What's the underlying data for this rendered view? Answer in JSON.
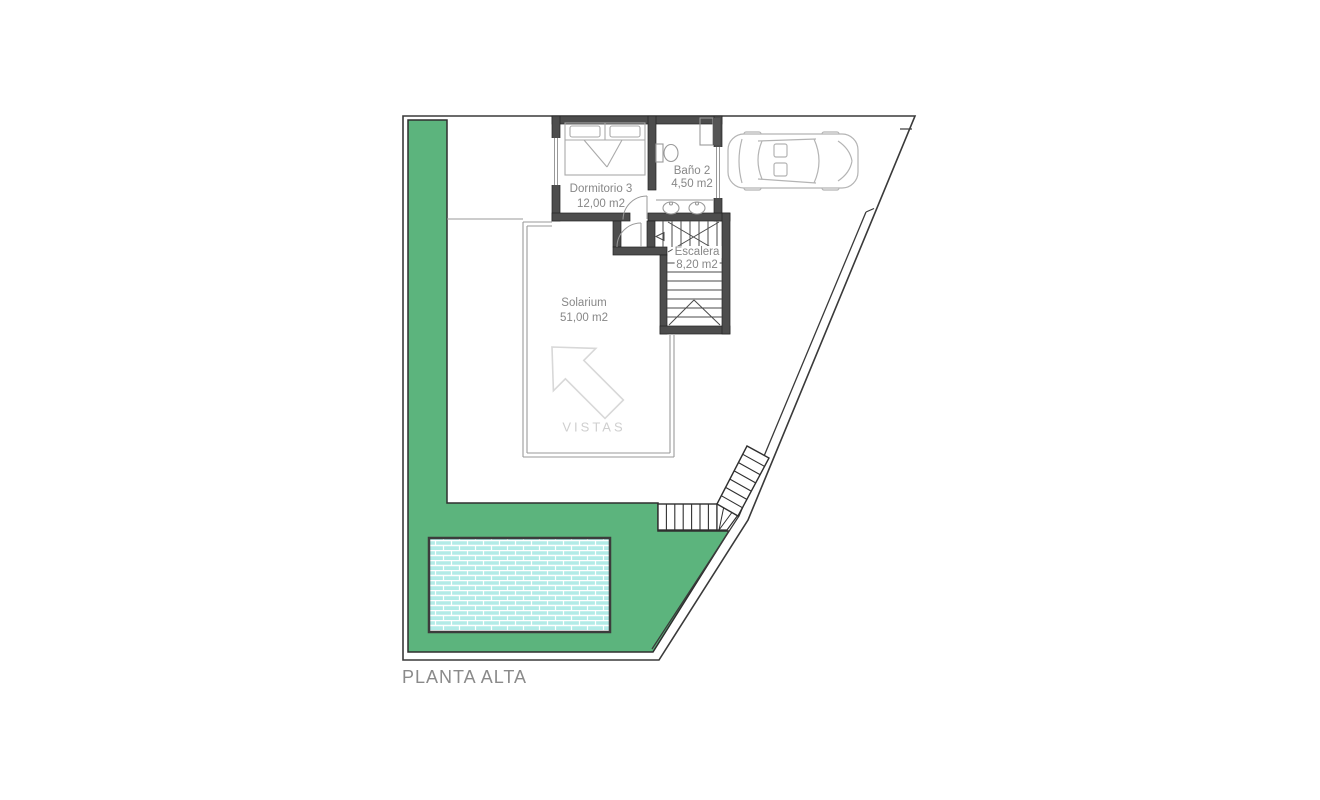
{
  "plan": {
    "title": "PLANTA ALTA",
    "rooms": {
      "dormitorio3": {
        "name": "Dormitorio 3",
        "area": "12,00 m2"
      },
      "bano2": {
        "name": "Baño 2",
        "area": "4,50 m2"
      },
      "escalera": {
        "name": "Escalera",
        "area": "8,20 m2"
      },
      "solarium": {
        "name": "Solarium",
        "area": "51,00 m2"
      }
    },
    "annotations": {
      "vistas": "VISTAS"
    },
    "colors": {
      "garden": "#5cb47d",
      "pool_water": "#b2ebe7",
      "pool_mortar": "#ffffff",
      "pool_border": "#3c3c3c",
      "wall": "#4d4d4d",
      "boundary": "#3a3a3a",
      "thin_line": "#9a9a9a",
      "furniture_line": "#aaaaaa",
      "car_line": "#b4b4b4",
      "stair_line": "#4a4a4a",
      "label_text": "#878787",
      "vistas_text": "#cfcfcf"
    }
  }
}
